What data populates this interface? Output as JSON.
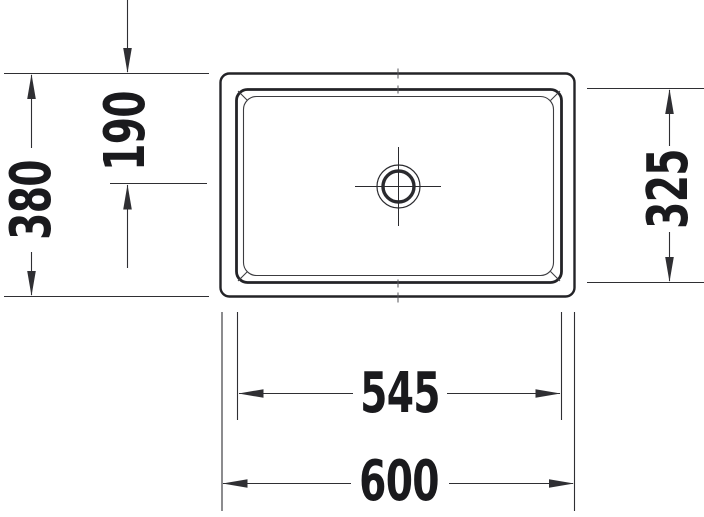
{
  "figure": {
    "colors": {
      "background": "#ffffff",
      "outline": "#232327",
      "dimension_line": "#2f2f33",
      "text": "#1a1a1d"
    },
    "symbols": [
      "drain-symbol",
      "centerline-cross"
    ]
  },
  "dimension_labels": {
    "overall_depth": "380",
    "drain_center_offset": "190",
    "basin_depth": "325",
    "basin_width": "545",
    "overall_width": "600"
  }
}
